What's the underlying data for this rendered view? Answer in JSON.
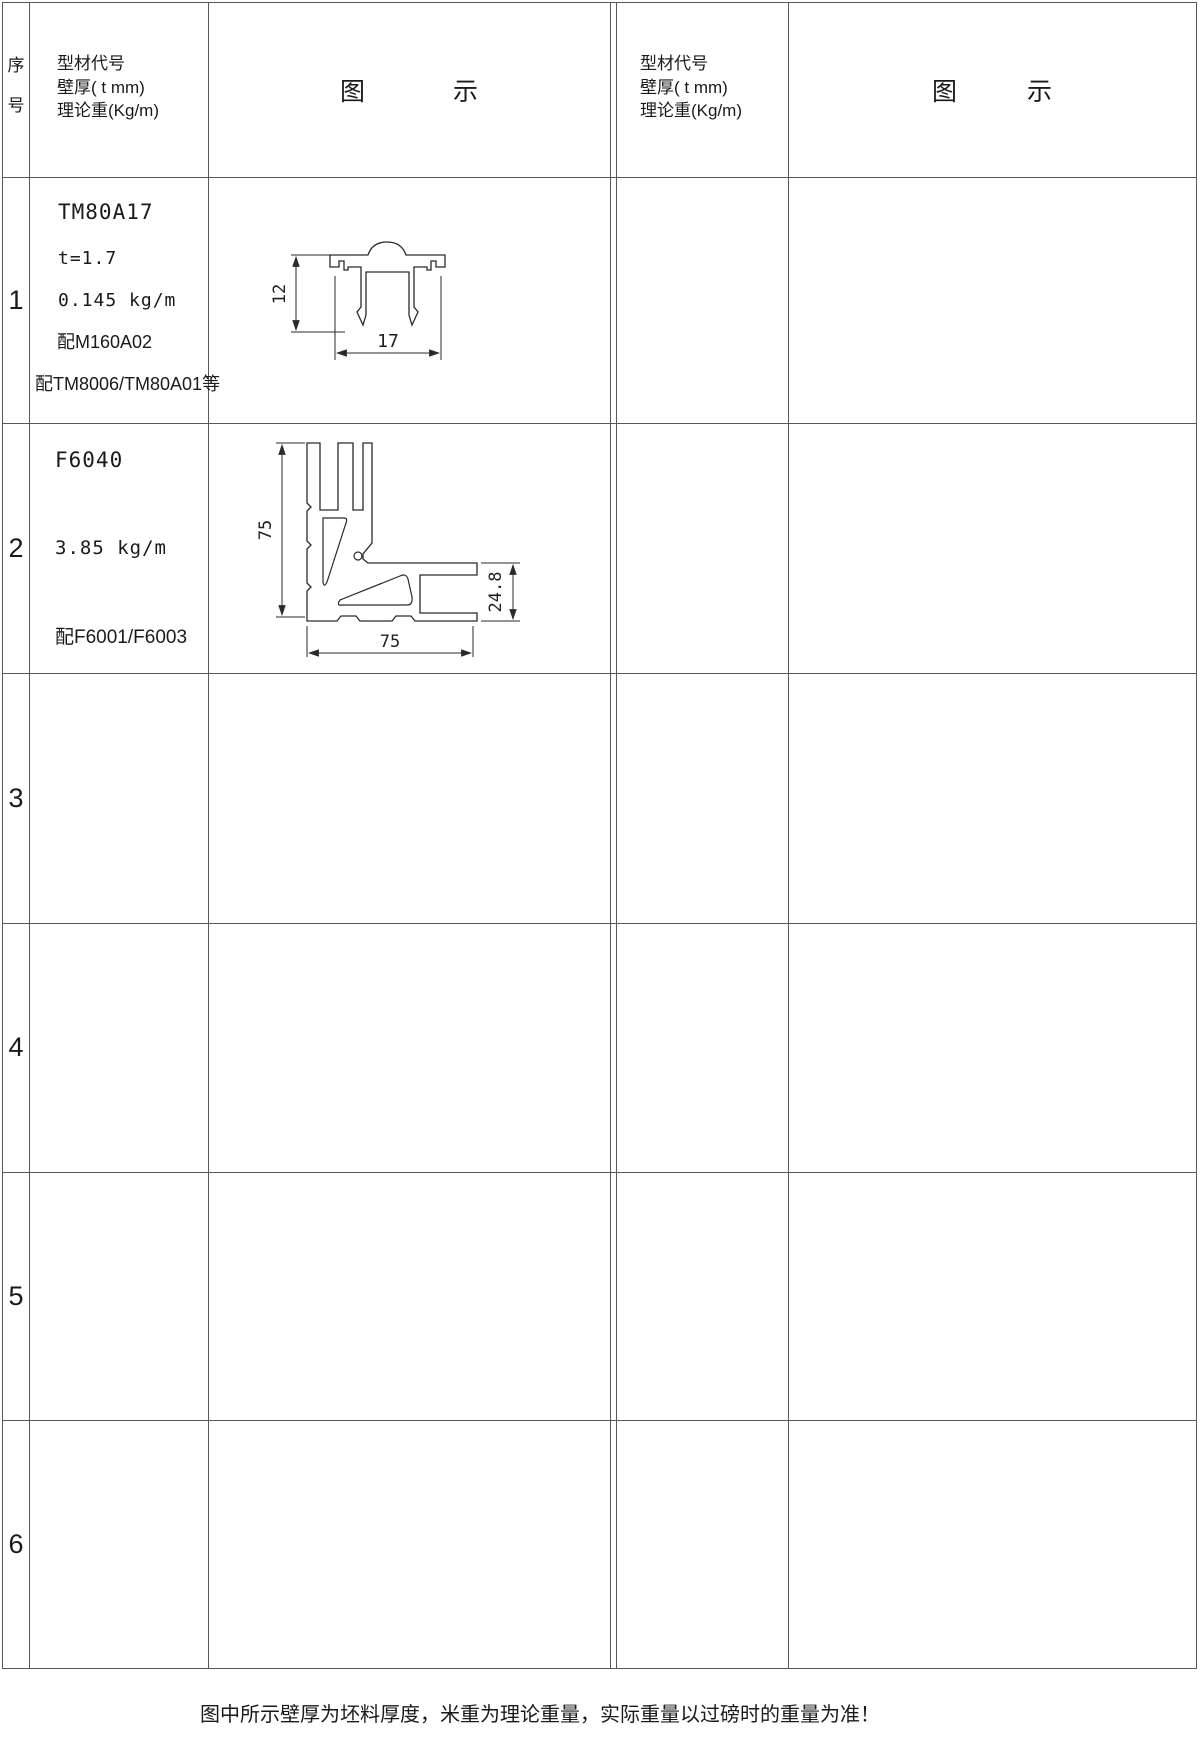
{
  "header": {
    "seq": [
      "序",
      "号"
    ],
    "spec_lines": [
      "型材代号",
      "壁厚( t mm)",
      "理论重(Kg/m)"
    ],
    "diagram": [
      "图",
      "示"
    ]
  },
  "rows": {
    "r1": {
      "no": "1",
      "code": "TM80A17",
      "thickness": "t=1.7",
      "weight": "0.145 kg/m",
      "match1": "配M160A02",
      "match2": "配TM8006/TM80A01等"
    },
    "r2": {
      "no": "2",
      "code": "F6040",
      "weight": "3.85 kg/m",
      "match1": "配F6001/F6003"
    },
    "r3": {
      "no": "3"
    },
    "r4": {
      "no": "4"
    },
    "r5": {
      "no": "5"
    },
    "r6": {
      "no": "6"
    }
  },
  "diagrams": {
    "d1": {
      "dim_height": "12",
      "dim_width": "17"
    },
    "d2": {
      "dim_left": "75",
      "dim_bottom": "75",
      "dim_right": "24.8"
    }
  },
  "footer": {
    "note": "图中所示壁厚为坯料厚度，米重为理论重量，实际重量以过磅时的重量为准！"
  },
  "colors": {
    "line": "#575757",
    "text": "#1a1a1a"
  }
}
